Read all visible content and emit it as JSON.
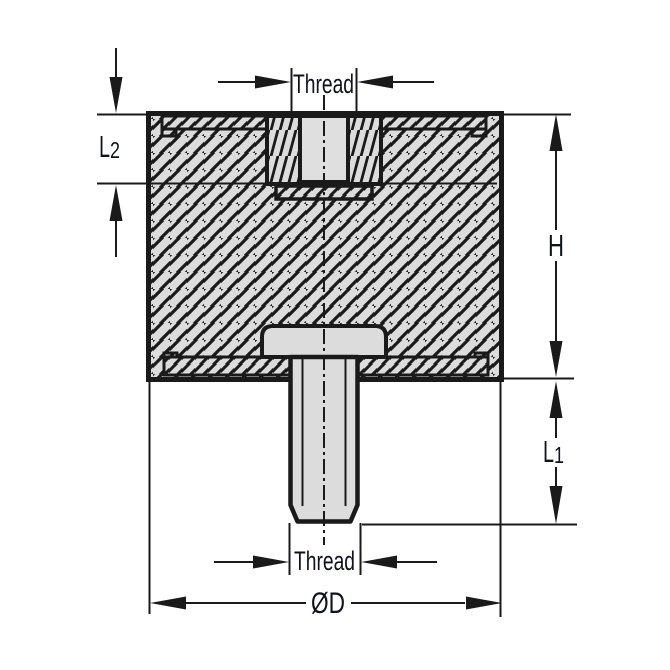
{
  "drawing": {
    "type": "cross-section technical drawing of a cylindrical rubber vibration mount (female thread insert on top, male threaded stud on bottom)",
    "labels": {
      "thread_top": "Thread",
      "thread_bottom": "Thread",
      "l2": {
        "base": "L",
        "sub": "2"
      },
      "h": "H",
      "l1": {
        "base": "L",
        "sub": "1"
      },
      "od": "ØD"
    },
    "colors": {
      "background": "#ffffff",
      "line": "#1a1a1a",
      "part_fill": "#dcdcdc",
      "hole_fill": "#dfdfdf",
      "text": "#10131c"
    }
  }
}
